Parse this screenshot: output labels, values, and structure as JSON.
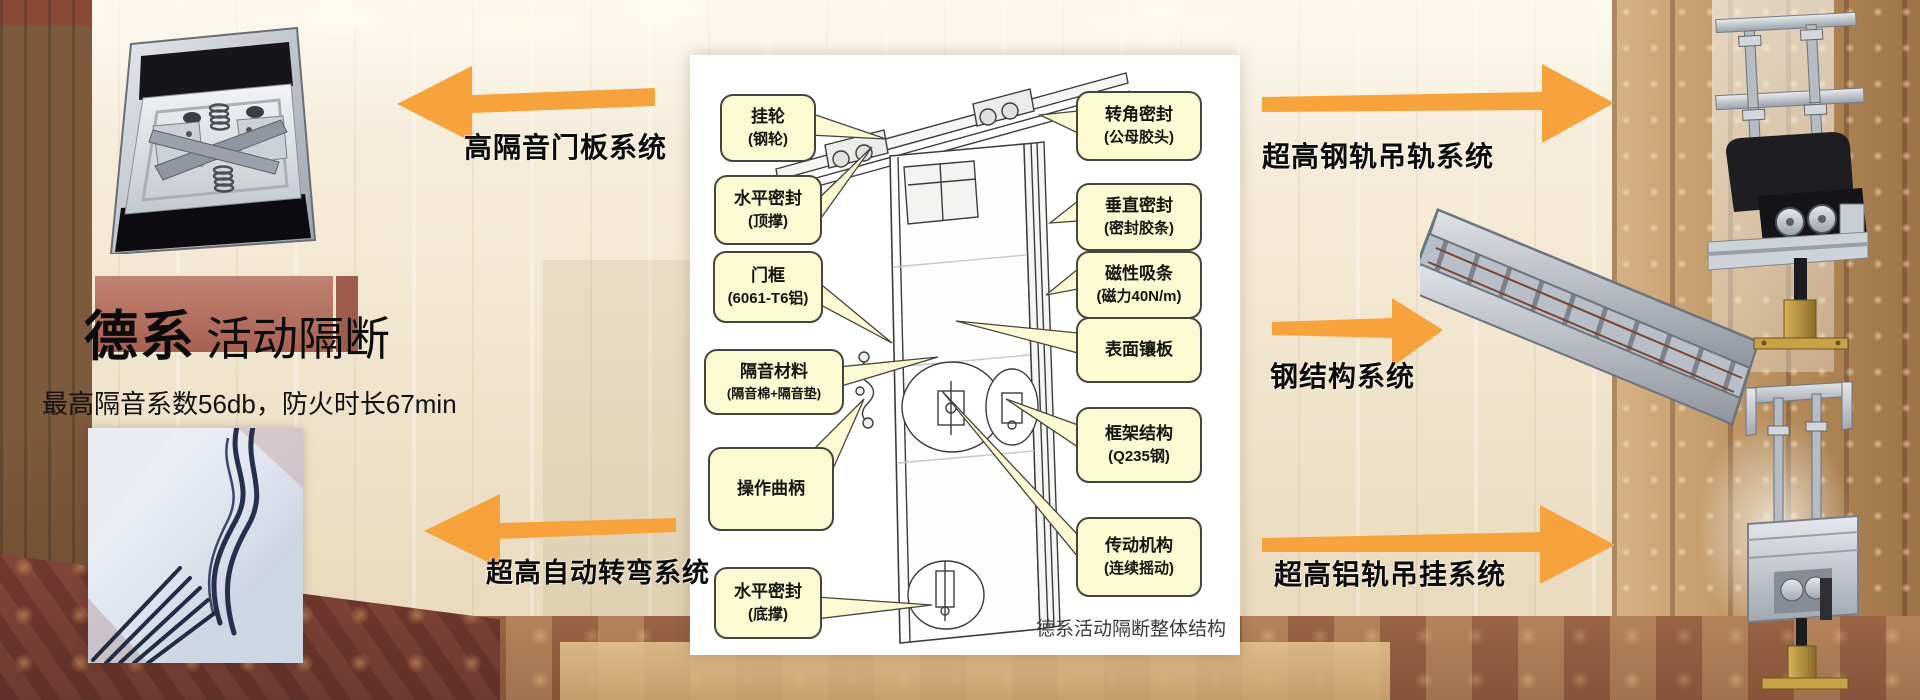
{
  "colors": {
    "arrow_orange": "#F6A33E",
    "callout_bg": "#FCFAD2",
    "callout_border": "#45453B"
  },
  "header": {
    "brand": "德系",
    "product": "活动隔断",
    "subtitle": "最高隔音系数56db，防火时长67min"
  },
  "system_labels": {
    "door_panel": "高隔音门板系统",
    "auto_turn": "超高自动转弯系统",
    "steel_rail": "超高钢轨吊轨系统",
    "steel_structure": "钢结构系统",
    "alu_rail": "超高铝轨吊挂系统"
  },
  "diagram": {
    "caption": "德系活动隔断整体结构",
    "left_callouts": [
      {
        "line1": "挂轮",
        "line2": "(钢轮)"
      },
      {
        "line1": "水平密封",
        "line2": "(顶撑)"
      },
      {
        "line1": "门框",
        "line2": "(6061-T6铝)"
      },
      {
        "line1": "隔音材料",
        "line2": "(隔音棉+隔音垫)"
      },
      {
        "line1": "操作曲柄",
        "line2": ""
      },
      {
        "line1": "水平密封",
        "line2": "(底撑)"
      }
    ],
    "right_callouts": [
      {
        "line1": "转角密封",
        "line2": "(公母胶头)"
      },
      {
        "line1": "垂直密封",
        "line2": "(密封胶条)"
      },
      {
        "line1": "磁性吸条",
        "line2": "(磁力40N/m)"
      },
      {
        "line1": "表面镶板",
        "line2": ""
      },
      {
        "line1": "框架结构",
        "line2": "(Q235钢)"
      },
      {
        "line1": "传动机构",
        "line2": "(连续摇动)"
      }
    ]
  }
}
